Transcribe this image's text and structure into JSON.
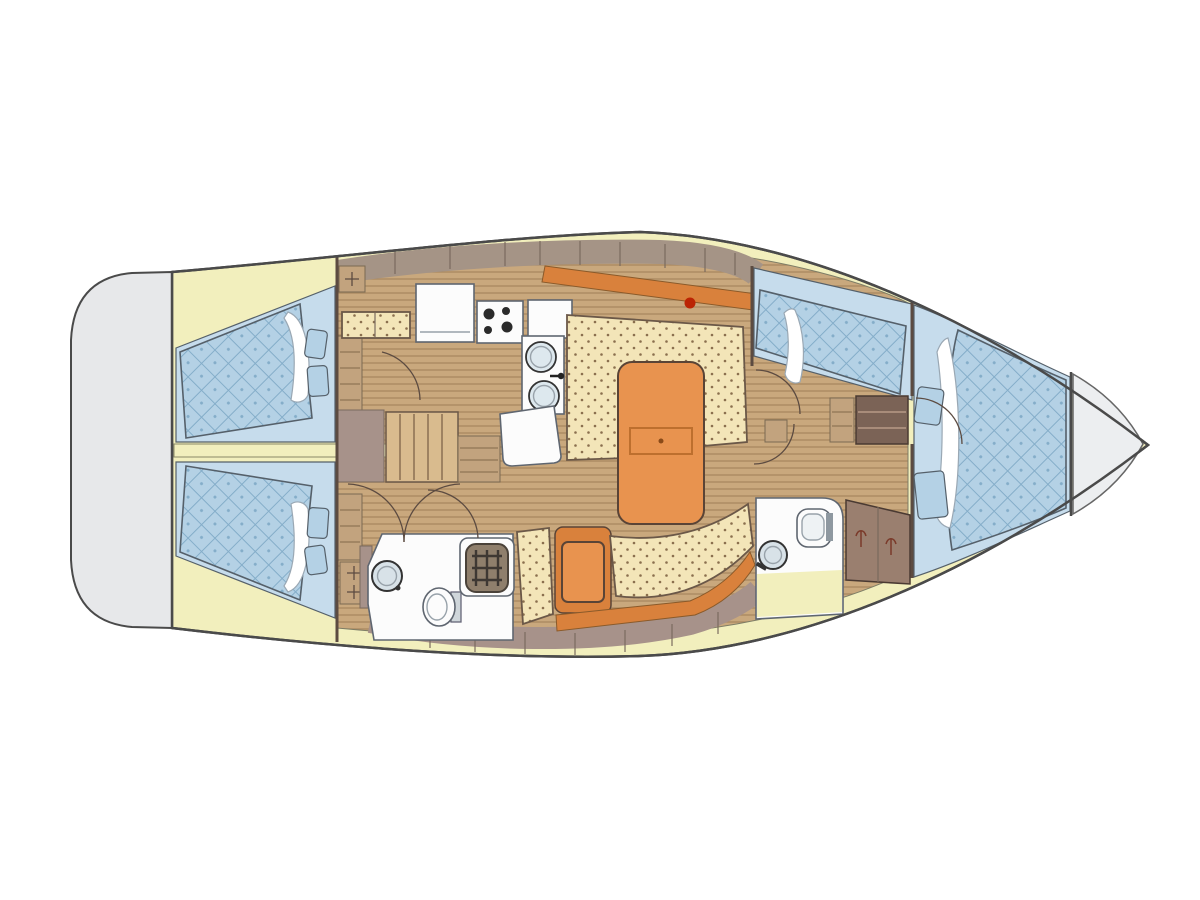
{
  "colors": {
    "hull-stroke": "#4a4a4a",
    "transom-gray": "#e7e8ea",
    "deck-yellow": "#f2efbd",
    "floor-wood": "#c9a87d",
    "floor-line": "#ab8a62",
    "step-wood": "#d9bb8e",
    "cabin-blue": "#c6dcec",
    "quilt-blue": "#b4d1e5",
    "quilt-line": "#84adc9",
    "cream": "#f3e5b8",
    "dot-brown": "#8a6f4e",
    "orange": "#e8934f",
    "orange-dark": "#d9813c",
    "mauve": "#a7928a",
    "wall-brown": "#5c4b41",
    "cabinet-tan": "#a59486",
    "storage-brown": "#7b6356",
    "wardrobe-brown": "#9a7f6f",
    "wood-slat": "#c2a37e",
    "white-fix": "#fcfcfc",
    "fix-stroke": "#5f6670",
    "sink-blue": "#dde8ee",
    "mast-red": "#bb2404",
    "grate-bg": "#8f7f6c",
    "grate-line": "#3e3833",
    "pillow-stroke": "#9aa8b4",
    "blue-edge": "#55606a",
    "locker-gray": "#eceef0"
  },
  "plan": {
    "drawing": "sailing-yacht-interior-layout-plan",
    "orientation": "bow-right-stern-left",
    "areas": [
      "stern-swim-platform",
      "aft-cabin-port",
      "aft-cabin-starboard",
      "companionway-steps",
      "galley",
      "salon",
      "aft-head",
      "nav-seating",
      "mid-cabin",
      "forward-head",
      "wardrobe",
      "forward-v-berth-cabin",
      "anchor-locker"
    ],
    "galley_features": [
      "refrigerator",
      "stove-four-burner",
      "double-sink",
      "counter"
    ],
    "aft_head_features": [
      "washbasin",
      "toilet",
      "shower-grate"
    ],
    "forward_head_features": [
      "washbasin",
      "toilet"
    ],
    "salon_features": [
      "u-settee",
      "folding-table",
      "mast-step",
      "swivel-seat",
      "curved-settee"
    ],
    "berths": {
      "aft_double": 2,
      "mid_single": 1,
      "forward_v": 1
    }
  }
}
